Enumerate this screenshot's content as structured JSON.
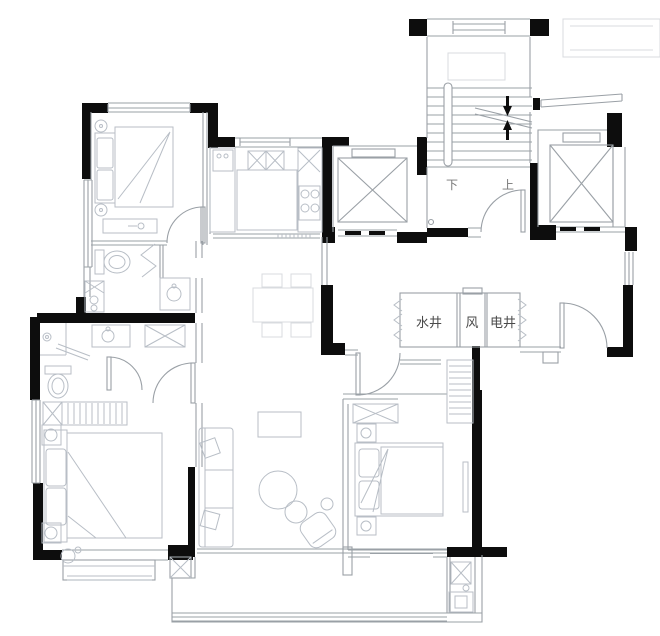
{
  "plan": {
    "labels": {
      "water_shaft": "水井",
      "vent_shaft": "风",
      "electric_shaft": "电井",
      "stair_down": "下",
      "stair_up": "上"
    },
    "colors": {
      "background": "#ffffff",
      "wall": "#0d0d0d",
      "line_medium": "#9aa0a6",
      "line_light": "#b8bec6",
      "line_faint": "#d8dbdf",
      "text": "#4a4a4a"
    }
  }
}
